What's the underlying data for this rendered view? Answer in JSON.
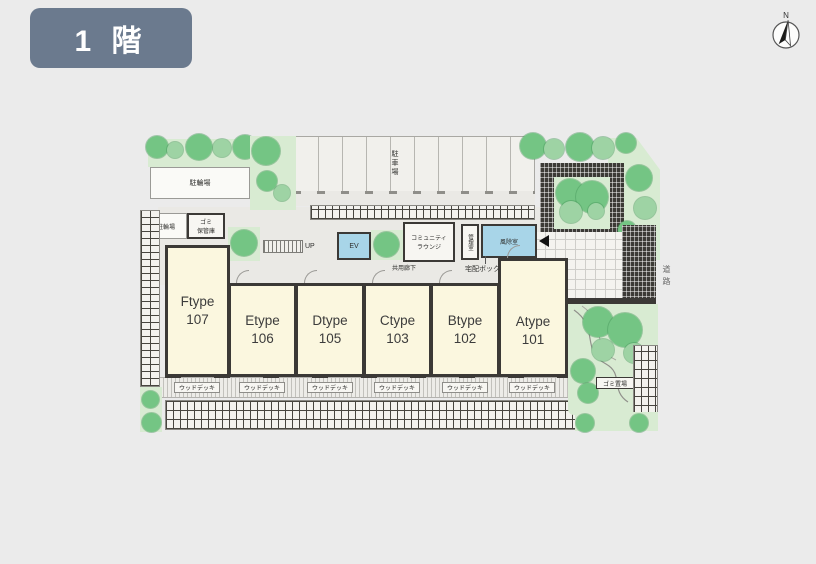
{
  "floor_badge": {
    "label": "1 階",
    "bg": "#6b7a8e"
  },
  "compass": {
    "north": "N"
  },
  "plan": {
    "labels": {
      "bicycle_top": "駐輪場",
      "bicycle_left": "駐輪場",
      "car_parking": "駐車場",
      "garbage_storage_line1": "ゴミ",
      "garbage_storage_line2": "保管庫",
      "stairs_up": "UP",
      "elevator": "EV",
      "lounge_line1": "コミュニティ",
      "lounge_line2": "ラウンジ",
      "management_room": "管理室",
      "windbreak_room": "風除室",
      "delivery_box": "宅配ボックス",
      "common_corridor": "共用廊下",
      "wood_deck": "ウッドデッキ",
      "garbage_area": "ゴミ置場",
      "road": "道路"
    },
    "units": [
      {
        "type": "Ftype",
        "number": "107"
      },
      {
        "type": "Etype",
        "number": "106"
      },
      {
        "type": "Dtype",
        "number": "105"
      },
      {
        "type": "Ctype",
        "number": "103"
      },
      {
        "type": "Btype",
        "number": "102"
      },
      {
        "type": "Atype",
        "number": "101"
      }
    ],
    "colors": {
      "room_fill": "#fbf7df",
      "elevator_fill": "#a8d5e8",
      "windbreak_fill": "#a8d5e8",
      "garden_fill": "#d8ebd2",
      "tree_fill": "#74c584",
      "wall": "#3b3936"
    }
  }
}
